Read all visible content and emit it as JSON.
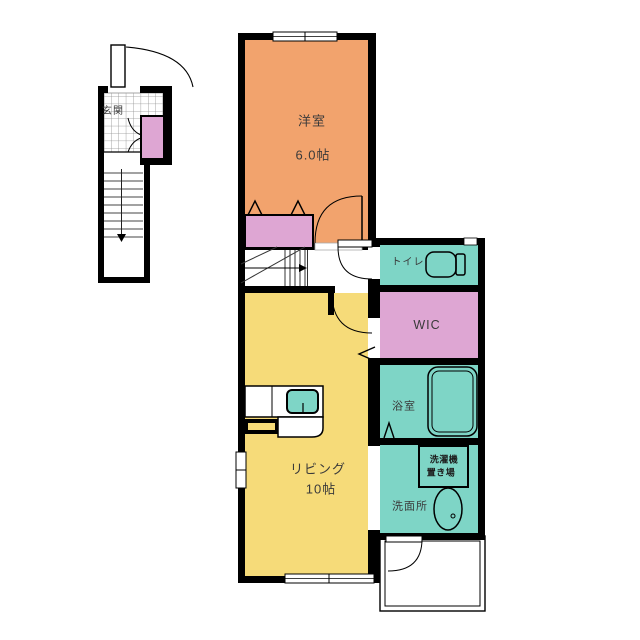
{
  "plan": {
    "type": "apartment-floor-plan",
    "rooms": {
      "entrance": {
        "label": "玄関"
      },
      "western_room": {
        "label": "洋室",
        "area": "6.0帖"
      },
      "living": {
        "label": "リビング",
        "area": "10帖"
      },
      "toilet": {
        "label": "トイレ"
      },
      "wic": {
        "label": "WIC"
      },
      "bath": {
        "label": "浴室"
      },
      "washroom": {
        "label": "洗面所"
      },
      "washer_space": {
        "line1": "洗濯機",
        "line2": "置き場"
      }
    },
    "colors": {
      "wall": "#000000",
      "room_orange": "#F2A36D",
      "room_yellow": "#F6DB79",
      "room_teal": "#7ED5C6",
      "room_pink": "#DEA6D3",
      "background": "#FFFFFF",
      "tile_grid": "#909090",
      "stair_line": "#444444"
    }
  }
}
